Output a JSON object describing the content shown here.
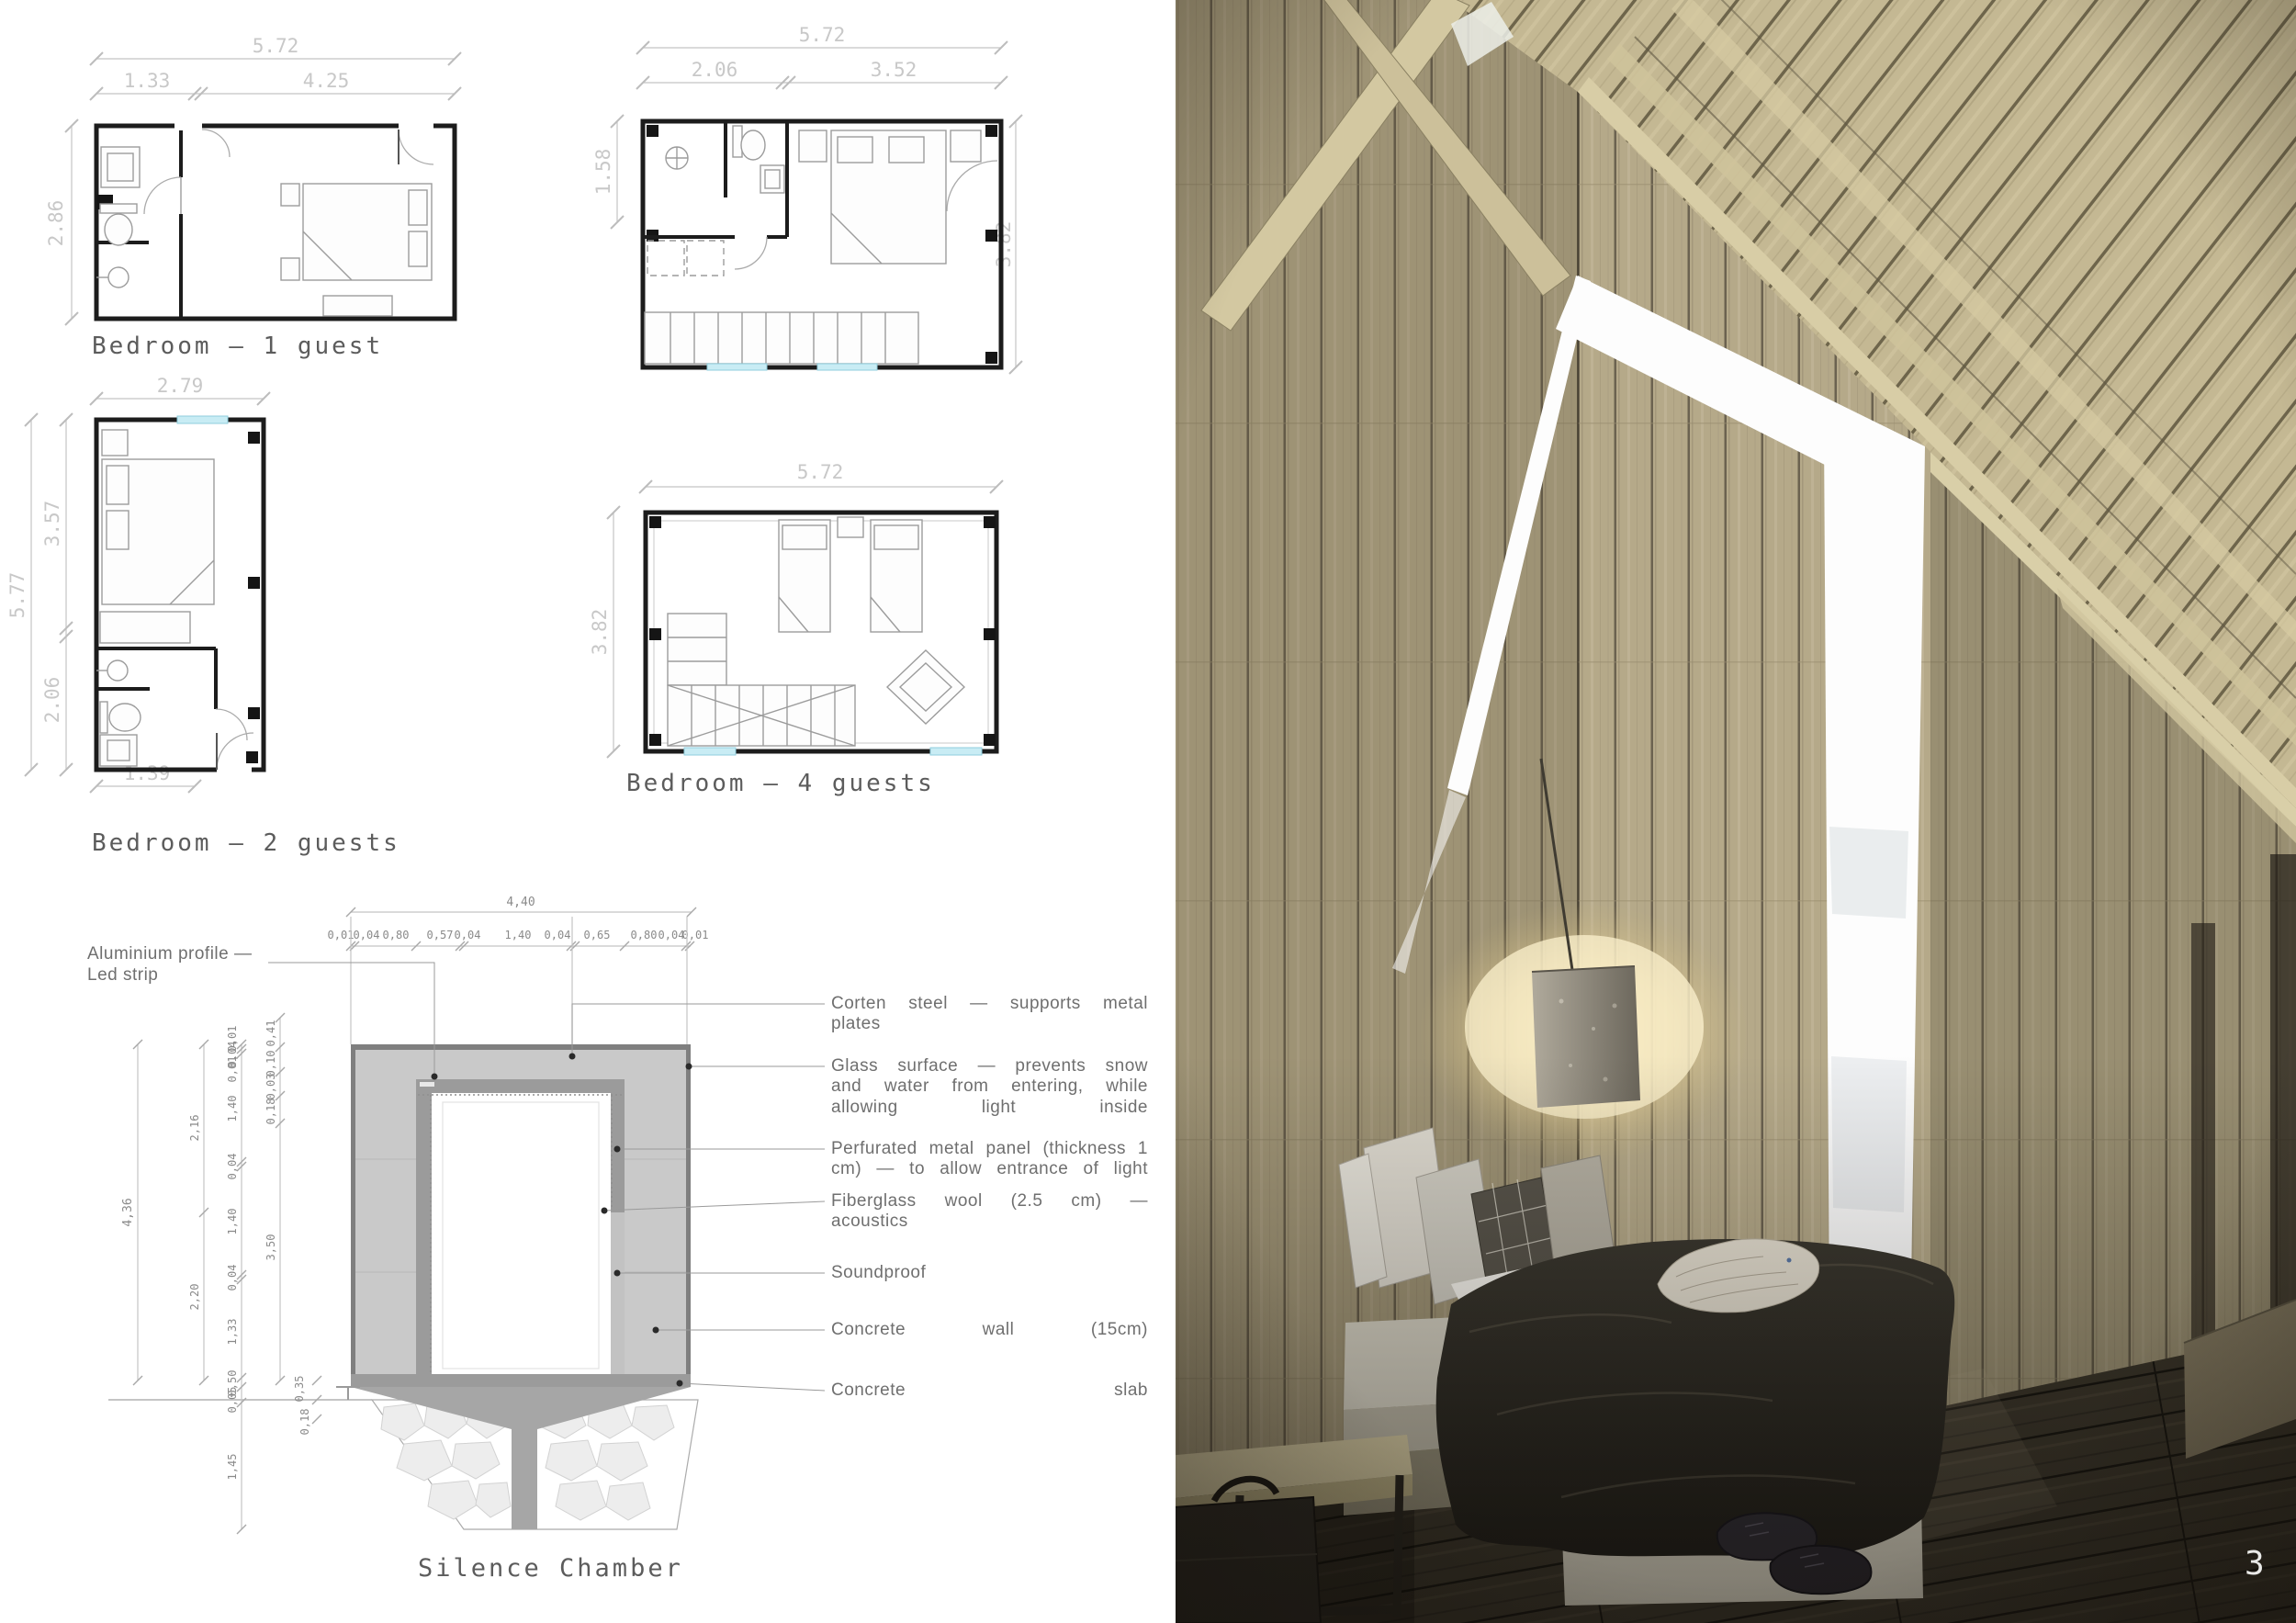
{
  "page": {
    "number": "3"
  },
  "plans": [
    {
      "id": "bedroom-1-guest",
      "title": "Bedroom — 1 guest",
      "dims": {
        "top_total": "5.72",
        "top_a": "1.33",
        "top_b": "4.25",
        "left": "2.86"
      }
    },
    {
      "id": "bedroom-upper-level",
      "title": "",
      "dims": {
        "top_total": "5.72",
        "top_a": "2.06",
        "top_b": "3.52",
        "left": "1.58",
        "right": "3.82"
      }
    },
    {
      "id": "bedroom-2-guests",
      "title": "Bedroom — 2 guests",
      "dims": {
        "top": "2.79",
        "left_outer": "5.77",
        "left_a": "3.57",
        "left_b": "2.06",
        "bottom": "1.39"
      }
    },
    {
      "id": "bedroom-4-guests",
      "title": "Bedroom — 4 guests",
      "dims": {
        "top": "5.72",
        "left": "3.82"
      }
    }
  ],
  "section": {
    "title": "Silence Chamber",
    "dims": {
      "total_width": "4,40",
      "top_chain": [
        "0,01",
        "0,04",
        "0,80",
        "0,57",
        "0,04",
        "1,40",
        "0,04",
        "0,65",
        "0,80",
        "0,04",
        "0,01"
      ],
      "left_total": "4,36",
      "left_mid": [
        "2,16",
        "2,20"
      ],
      "left_inner": [
        "0,01",
        "0,04",
        "0,01",
        "1,40",
        "0,04",
        "1,40",
        "0,04",
        "1,33",
        "0,50",
        "0,05"
      ],
      "inner_top": [
        "0,41",
        "0,10",
        "0,03",
        "0,18"
      ],
      "inner_height": "3,50",
      "bottom": [
        "0,35",
        "0,18"
      ],
      "below_ground": "1,45"
    },
    "left_label": {
      "line1": "Aluminium profile —",
      "line2": "Led strip"
    },
    "callouts": [
      {
        "text": "Corten steel — supports metal plates"
      },
      {
        "text": "Glass surface — prevents snow and water from entering, while allowing light inside"
      },
      {
        "text": "Perfurated metal panel (thickness 1 cm) — to allow entrance of light"
      },
      {
        "text": "Fiberglass wool (2.5 cm) — acoustics"
      },
      {
        "text": "Soundproof"
      },
      {
        "text": "Concrete wall (15cm)"
      },
      {
        "text": "Concrete slab"
      }
    ]
  },
  "photo": {
    "page_number": "3"
  }
}
